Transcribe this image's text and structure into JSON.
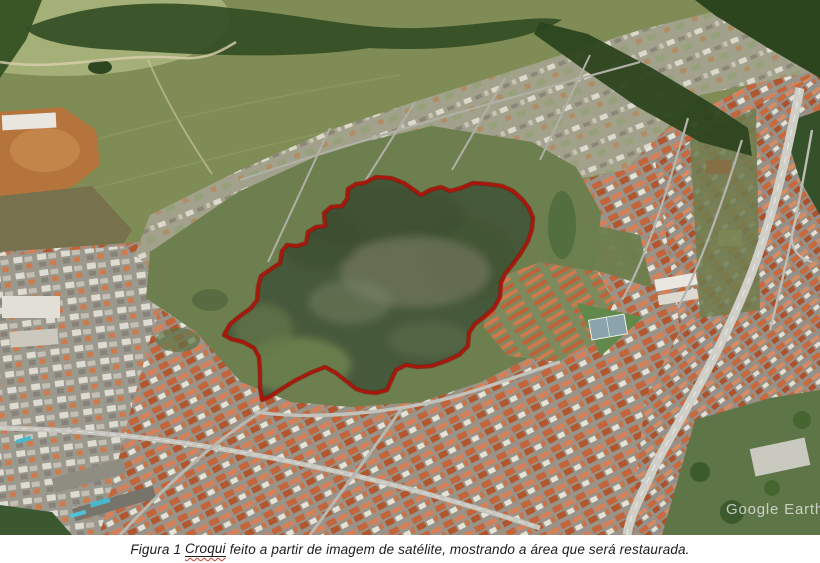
{
  "figure": {
    "watermark_text": "Google Earth",
    "outline_color": "#a9170b"
  },
  "caption": {
    "figure_label": "Figura 1 ",
    "underlined_word": "Croqui",
    "text_after": " feito a partir de imagem de satélite, mostrando a área que será restaurada."
  }
}
